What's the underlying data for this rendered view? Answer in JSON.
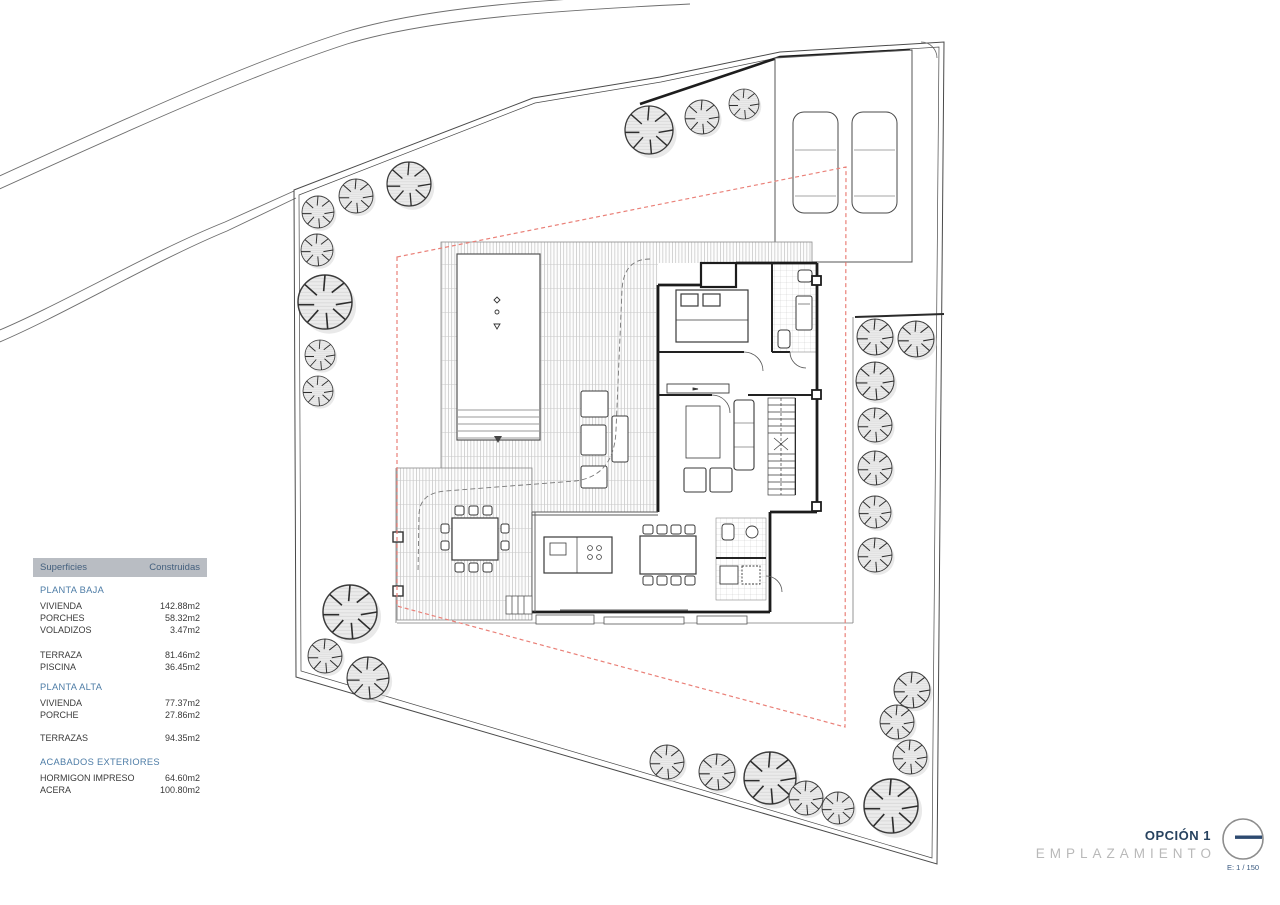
{
  "table": {
    "header": {
      "col1": "Superficies",
      "col2": "Construidas"
    },
    "sections": [
      {
        "title": "PLANTA BAJA",
        "rows": [
          {
            "label": "VIVIENDA",
            "value": "142.88m2"
          },
          {
            "label": "PORCHES",
            "value": "58.32m2"
          },
          {
            "label": "VOLADIZOS",
            "value": "3.47m2"
          }
        ]
      },
      {
        "title": "",
        "rows": [
          {
            "label": "TERRAZA",
            "value": "81.46m2"
          },
          {
            "label": "PISCINA",
            "value": "36.45m2"
          }
        ]
      },
      {
        "title": "PLANTA ALTA",
        "rows": [
          {
            "label": "VIVIENDA",
            "value": "77.37m2"
          },
          {
            "label": "PORCHE",
            "value": "27.86m2"
          }
        ]
      },
      {
        "title": "",
        "rows": [
          {
            "label": "TERRAZAS",
            "value": "94.35m2"
          }
        ]
      },
      {
        "title": "ACABADOS EXTERIORES",
        "rows": [
          {
            "label": "HORMIGON IMPRESO",
            "value": "64.60m2"
          },
          {
            "label": "ACERA",
            "value": "100.80m2"
          }
        ]
      }
    ]
  },
  "title_block": {
    "option": "OPCIÓN 1",
    "name": "EMPLAZAMIENTO",
    "scale": "E: 1 / 150"
  },
  "drawing": {
    "type": "site-plan",
    "elements": [
      "plot-boundary",
      "road",
      "setback-line",
      "house-floor-plan",
      "pool",
      "terrace-deck",
      "parking",
      "cars",
      "trees"
    ],
    "colors": {
      "setback_red": "#ea8078",
      "tree_fill": "#ebebeb",
      "header_gray": "#b9bdc3",
      "accent_navy": "#27425f",
      "section_blue": "#4d7ca6",
      "title_gray": "#b9b9b9"
    }
  }
}
